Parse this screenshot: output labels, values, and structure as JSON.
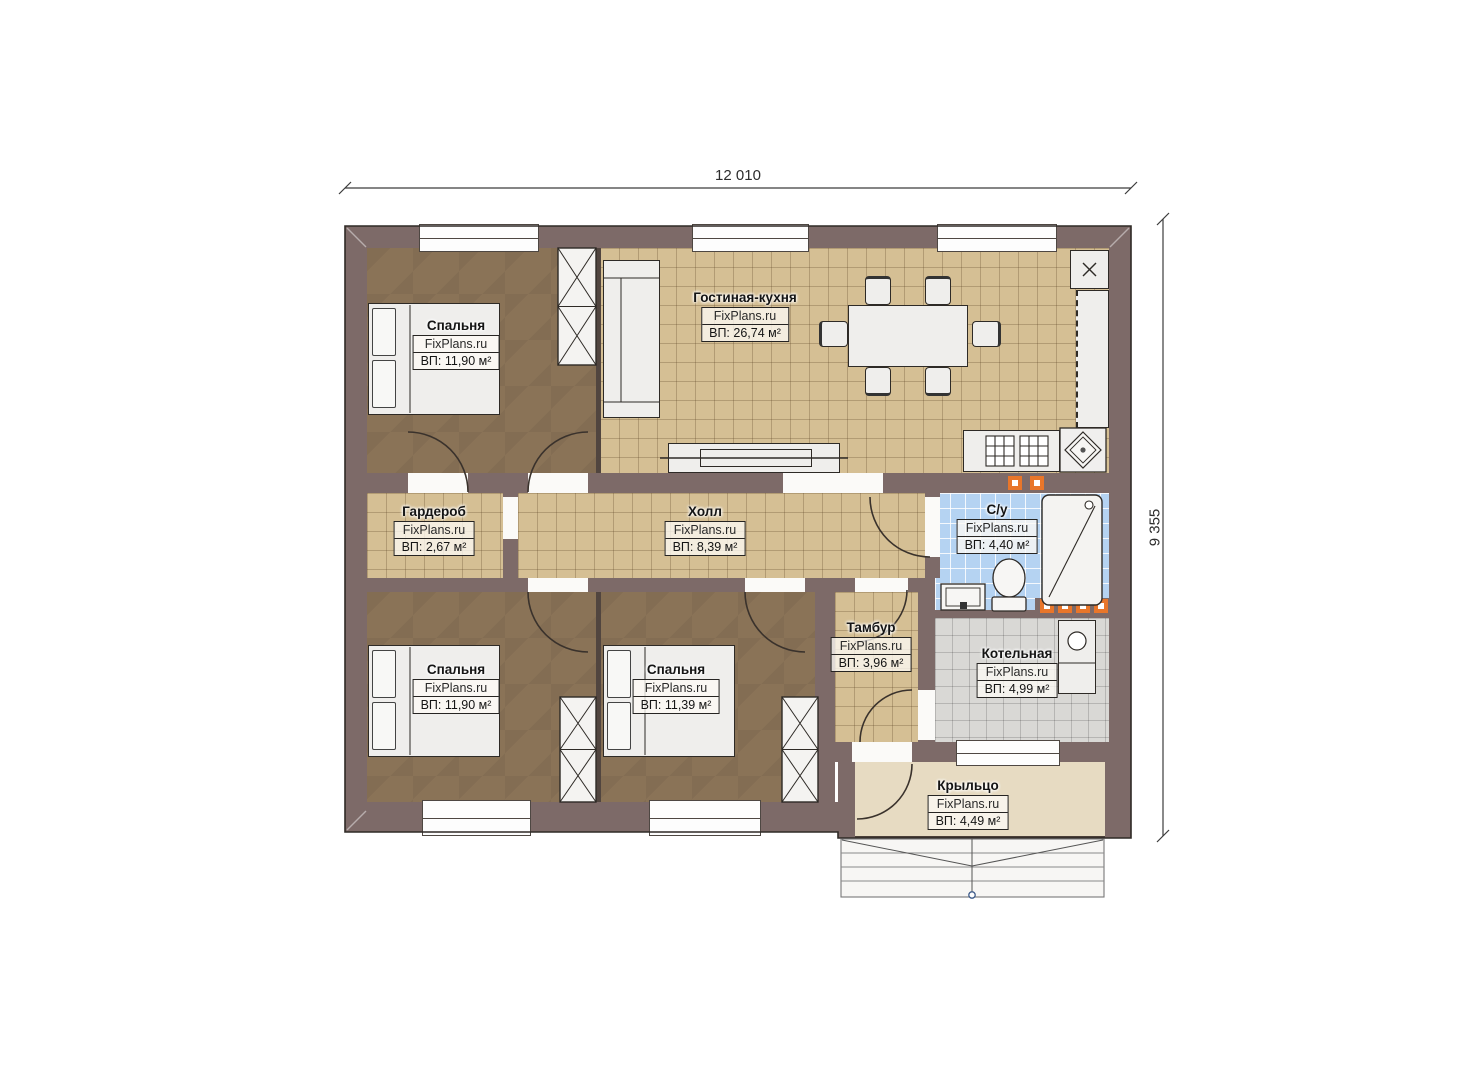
{
  "title": "Планировка одноэтажного дома",
  "watermark": "FixPlans.ru",
  "dimensions": {
    "width_label": "12 010",
    "height_label": "9 355"
  },
  "rooms": [
    {
      "id": "bedroom-1",
      "name": "Спальня",
      "area": "ВП: 11,90 м²"
    },
    {
      "id": "living-kitchen",
      "name": "Гостиная-кухня",
      "area": "ВП: 26,74 м²"
    },
    {
      "id": "wardrobe-room",
      "name": "Гардероб",
      "area": "ВП: 2,67 м²"
    },
    {
      "id": "hall",
      "name": "Холл",
      "area": "ВП: 8,39 м²"
    },
    {
      "id": "bathroom",
      "name": "С/у",
      "area": "ВП: 4,40 м²"
    },
    {
      "id": "bedroom-2",
      "name": "Спальня",
      "area": "ВП: 11,90 м²"
    },
    {
      "id": "bedroom-3",
      "name": "Спальня",
      "area": "ВП: 11,39 м²"
    },
    {
      "id": "vestibule",
      "name": "Тамбур",
      "area": "ВП: 3,96 м²"
    },
    {
      "id": "boiler-room",
      "name": "Котельная",
      "area": "ВП: 4,99 м²"
    },
    {
      "id": "porch",
      "name": "Крыльцо",
      "area": "ВП: 4,49 м²"
    }
  ],
  "colors": {
    "wall": "#7d6a68",
    "bedroom_floor": "#8a7357",
    "tile_tan": "#d5bf94",
    "tile_blue": "#b5d3f2",
    "tile_gray": "#d9d8d5",
    "porch_floor": "#e7dbc2",
    "accent_orange": "#e8762a"
  }
}
